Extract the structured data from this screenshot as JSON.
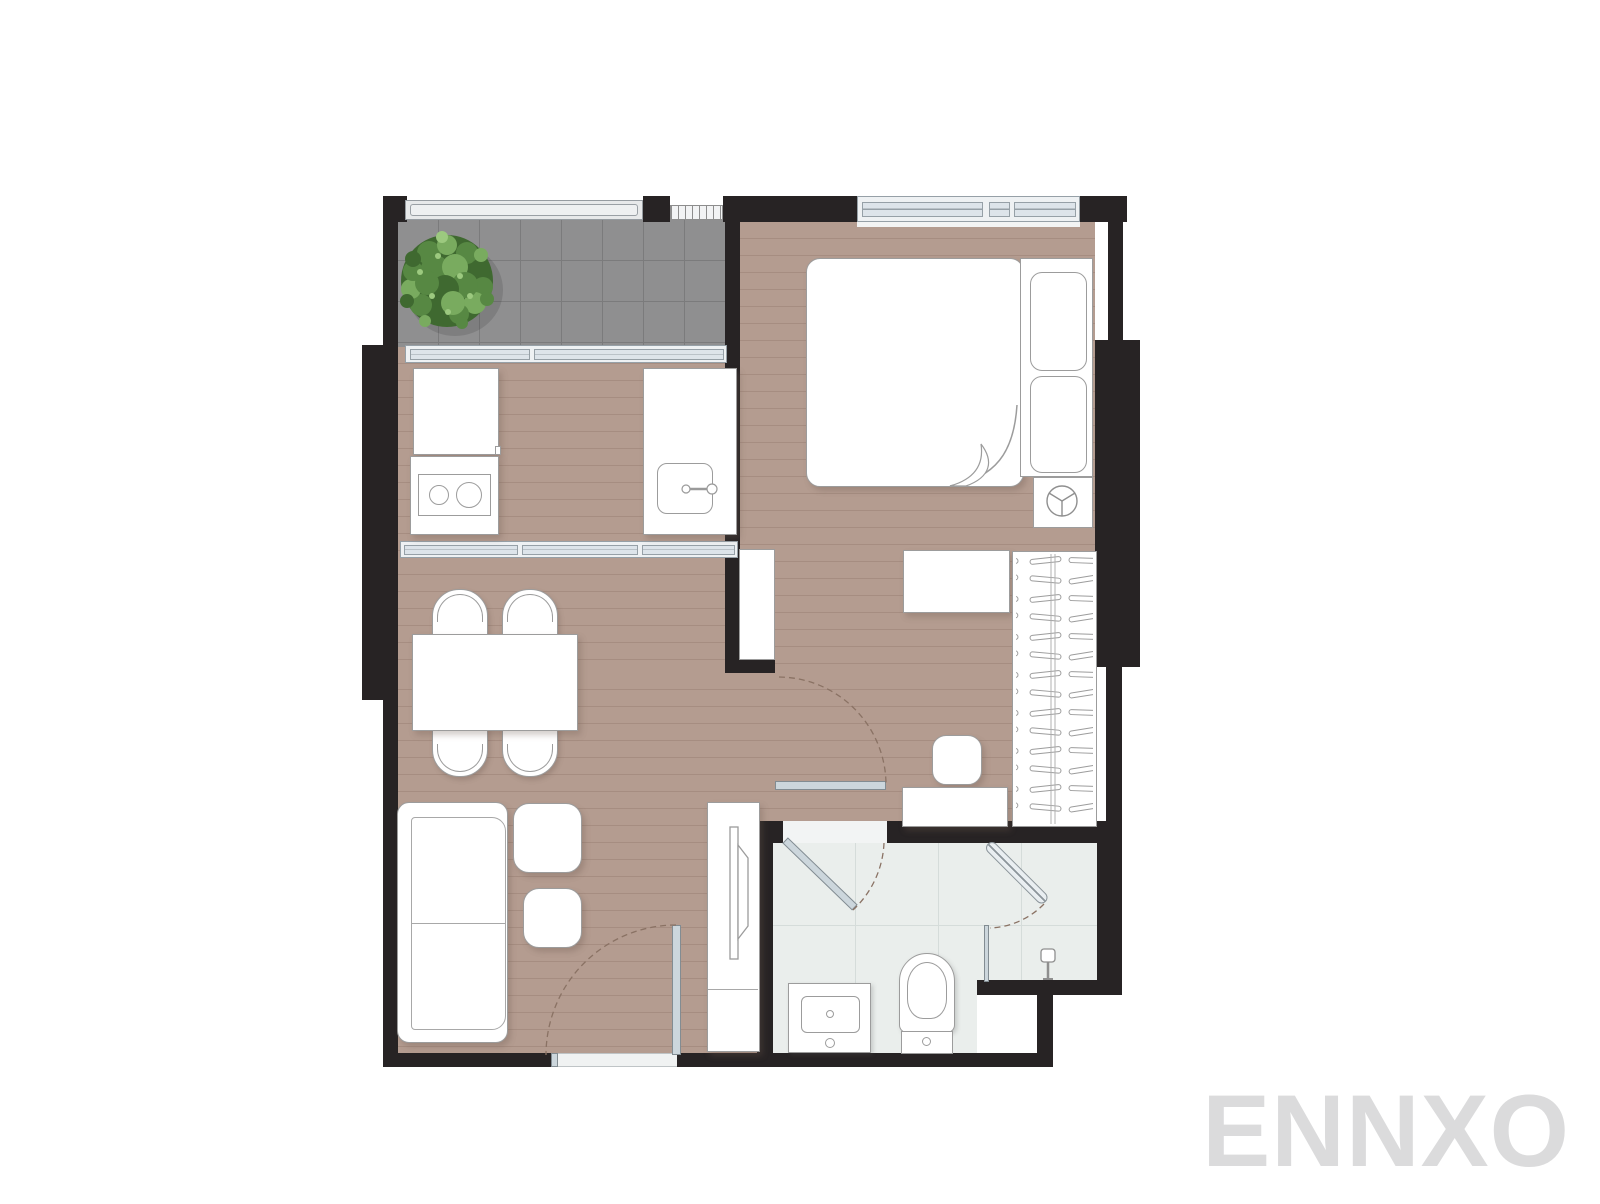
{
  "watermark": {
    "text": "ENNXO"
  },
  "palette": {
    "wall": "#272324",
    "wood_floor": "#b49c90",
    "wood_line": "#a68d81",
    "balcony_tile": "#8f8f90",
    "balcony_tile_line": "#7b7b7c",
    "bath_tile": "#eaeeec",
    "bath_tile_line": "#d5dcda",
    "glass_fill": "#dde4ea",
    "glass_frame": "#96a0a7",
    "railing_fill": "#e7e9ea",
    "furniture_fill": "#ffffff",
    "furniture_line": "#9c9c9c",
    "door_leaf": "#ccd6dc",
    "door_arc": "#8a7264",
    "tree_dark": "#3f6930",
    "tree_mid": "#578843",
    "tree_light": "#79ab5f",
    "tree_pale": "#9cc97f",
    "watermark_color": "#dbdbdc"
  },
  "rooms": [
    "balcony",
    "kitchen",
    "living-dining",
    "hallway",
    "bedroom",
    "bathroom"
  ],
  "icons": [
    "tree-icon",
    "railing-icon",
    "ac-louver-icon",
    "window-icon",
    "fridge-icon",
    "stove-icon",
    "kitchen-sink-icon",
    "faucet-icon",
    "dining-table-icon",
    "chair-icon",
    "sofa-icon",
    "side-table-icon",
    "tv-console-icon",
    "tv-icon",
    "entry-door-icon",
    "bedroom-door-icon",
    "bathroom-door-icon",
    "door-swing-arc-icon",
    "bed-icon",
    "blanket-fold-icon",
    "pillow-icon",
    "bedside-wheel-icon",
    "desk-icon",
    "stool-icon",
    "dresser-icon",
    "wardrobe-icon",
    "hanger-icon",
    "mirror-cabinet-icon",
    "toilet-icon",
    "vanity-sink-icon",
    "shower-door-icon",
    "shower-head-icon",
    "shower-glass-icon"
  ]
}
